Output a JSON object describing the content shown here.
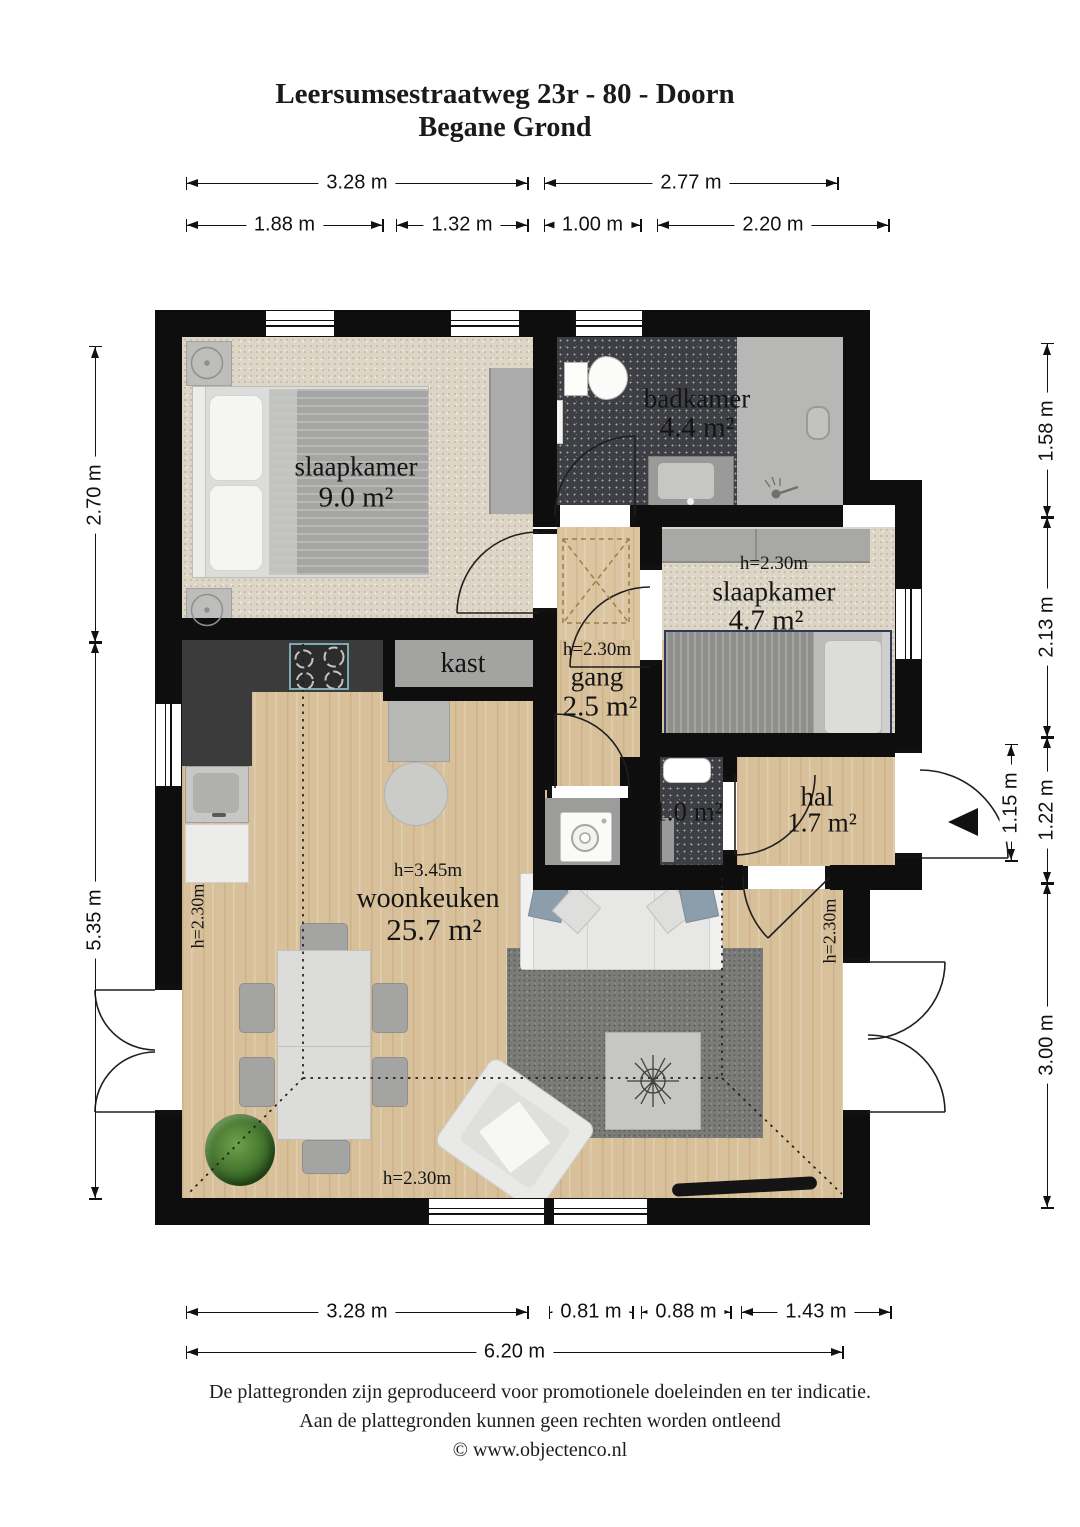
{
  "title": {
    "line1": "Leersumsestraatweg 23r - 80 - Doorn",
    "line2": "Begane Grond"
  },
  "rooms": {
    "slaapkamer_9": {
      "name": "slaapkamer",
      "area": "9.0 m²"
    },
    "badkamer": {
      "name": "badkamer",
      "area": "4.4 m²"
    },
    "slaapkamer_47": {
      "height": "h=2.30m",
      "name": "slaapkamer",
      "area": "4.7 m²"
    },
    "gang": {
      "height": "h=2.30m",
      "name": "gang",
      "area": "2.5 m²"
    },
    "kast": {
      "name": "kast"
    },
    "toilet": {
      "area": "1.0 m²"
    },
    "hal": {
      "name": "hal",
      "area": "1.7 m²"
    },
    "woonkeuken": {
      "height": "h=3.45m",
      "name": "woonkeuken",
      "area": "25.7 m²"
    },
    "height_left": "h=2.30m",
    "height_bottom": "h=2.30m",
    "height_right": "h=2.30m"
  },
  "dims": {
    "top1_a": "3.28 m",
    "top1_b": "2.77 m",
    "top2_a": "1.88 m",
    "top2_b": "1.32 m",
    "top2_c": "1.00 m",
    "top2_d": "2.20 m",
    "left_a": "2.70 m",
    "left_b": "5.35 m",
    "right_a": "1.58 m",
    "right_b": "2.13 m",
    "right_c": "1.22 m",
    "right_d": "3.00 m",
    "right_inner": "1.15 m",
    "bottom1_a": "3.28 m",
    "bottom1_b": "0.81 m",
    "bottom1_c": "0.88 m",
    "bottom1_d": "1.43 m",
    "bottom2_a": "6.20 m"
  },
  "footer": {
    "line1": "De plattegronden zijn geproduceerd voor promotionele doeleinden en ter indicatie.",
    "line2": "Aan de plattegronden kunnen geen rechten worden ontleend",
    "line3": "© www.objectenco.nl"
  },
  "colors": {
    "wall": "#0e0e0e",
    "wood_floor": "#d8c19a",
    "dark_tile": "#3d3f45",
    "beige_carpet": "#ddd5c6",
    "hob_accent": "#7fa8b5",
    "bed_trim_navy": "#2e3a55"
  }
}
